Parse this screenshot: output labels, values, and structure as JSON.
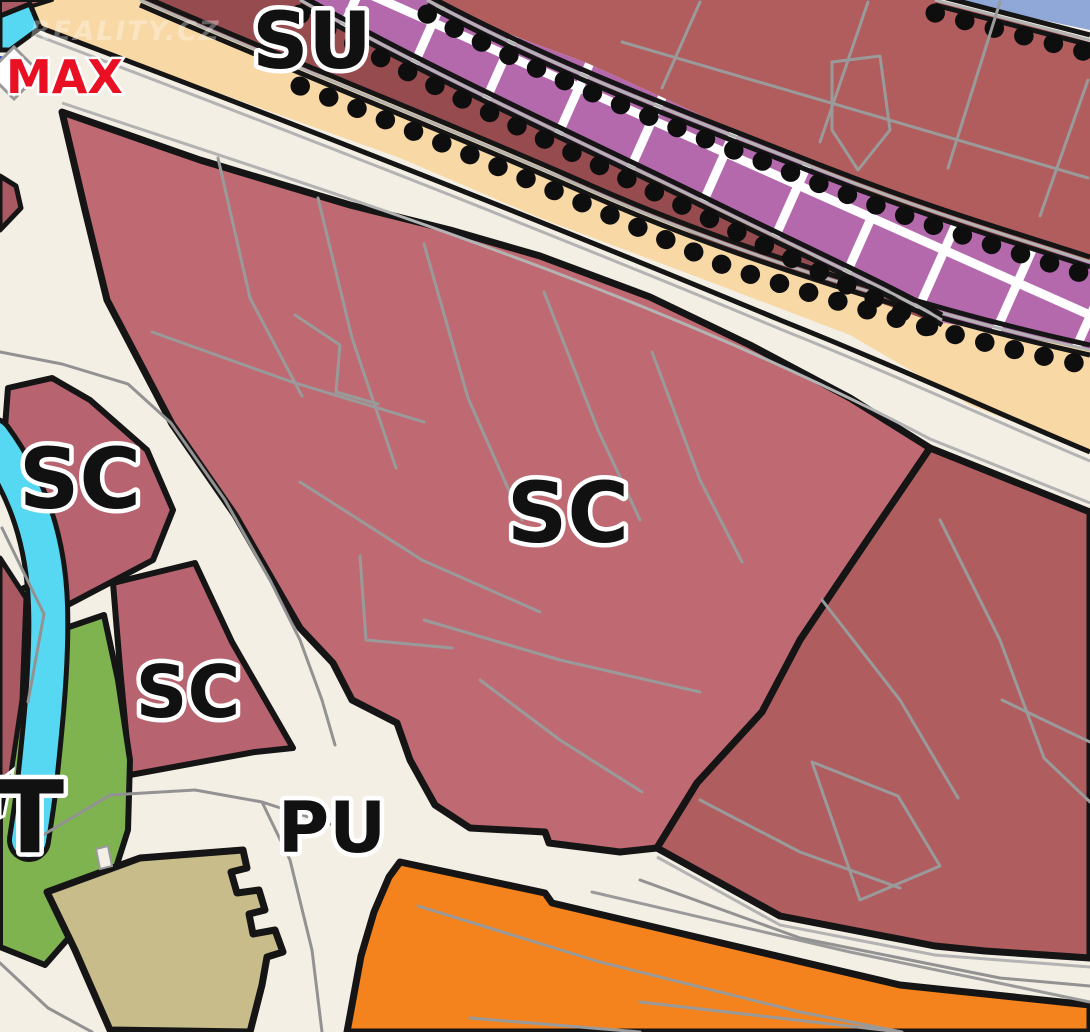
{
  "map": {
    "kind": "zoning-plan-map-screenshot",
    "watermark": {
      "text": "REALITY.CZ"
    },
    "labels": [
      {
        "id": "su",
        "text": "SU"
      },
      {
        "id": "sc-central",
        "text": "SC"
      },
      {
        "id": "sc-west",
        "text": "SC"
      },
      {
        "id": "sc-small",
        "text": "SC"
      },
      {
        "id": "pu",
        "text": "PU"
      },
      {
        "id": "t",
        "text": "T"
      },
      {
        "id": "max",
        "text": "MAX"
      }
    ],
    "zones": [
      {
        "id": "sc-central",
        "code": "SC",
        "color": "#bf6a72"
      },
      {
        "id": "sc-west-parcel",
        "code": "SC",
        "color": "#b86470"
      },
      {
        "id": "sc-small-parcel",
        "code": "SC",
        "color": "#b86470"
      },
      {
        "id": "su-strip",
        "code": "SU",
        "color": "#964c4f"
      },
      {
        "id": "pu-roads",
        "code": "PU",
        "color": "#f4efe4"
      },
      {
        "id": "green-strip",
        "code": "T",
        "color": "#7fb350"
      },
      {
        "id": "right-zone",
        "code": "",
        "color": "#b05d60"
      },
      {
        "id": "upper-zone",
        "code": "",
        "color": "#b15d5e"
      },
      {
        "id": "purple-hatch",
        "code": "",
        "color": "#b569ad"
      },
      {
        "id": "peach-corridor",
        "code": "",
        "color": "#f8d8a4"
      },
      {
        "id": "khaki-zone",
        "code": "",
        "color": "#c8bc8b"
      },
      {
        "id": "orange-zone",
        "code": "",
        "color": "#f5831d"
      },
      {
        "id": "river",
        "code": "",
        "color": "#56d8f2"
      }
    ],
    "colors": {
      "background_road": "#f4efe4",
      "sc_central": "#bf6a72",
      "sc_parcel": "#b86470",
      "right_zone": "#b05d60",
      "upper_zone": "#b15d5e",
      "su_strip": "#964c4f",
      "maroon_wedge": "#a85962",
      "peach_corridor": "#f8d8a4",
      "purple_hatch": "#b569ad",
      "hatch_grid": "#ffffff",
      "green_zone": "#7fb350",
      "water": "#56d8f2",
      "khaki_zone": "#c8bc8b",
      "orange_zone": "#f5831d",
      "boundary_black": "#151515",
      "parcel_gray": "#9a9a9a",
      "corner_blue": "#8fa8d8",
      "sliver_blue": "#3548c8",
      "label_black": "#111111",
      "label_halo": "#ffffff",
      "max_red": "#e81022",
      "watermark_white": "#ffffff"
    }
  }
}
